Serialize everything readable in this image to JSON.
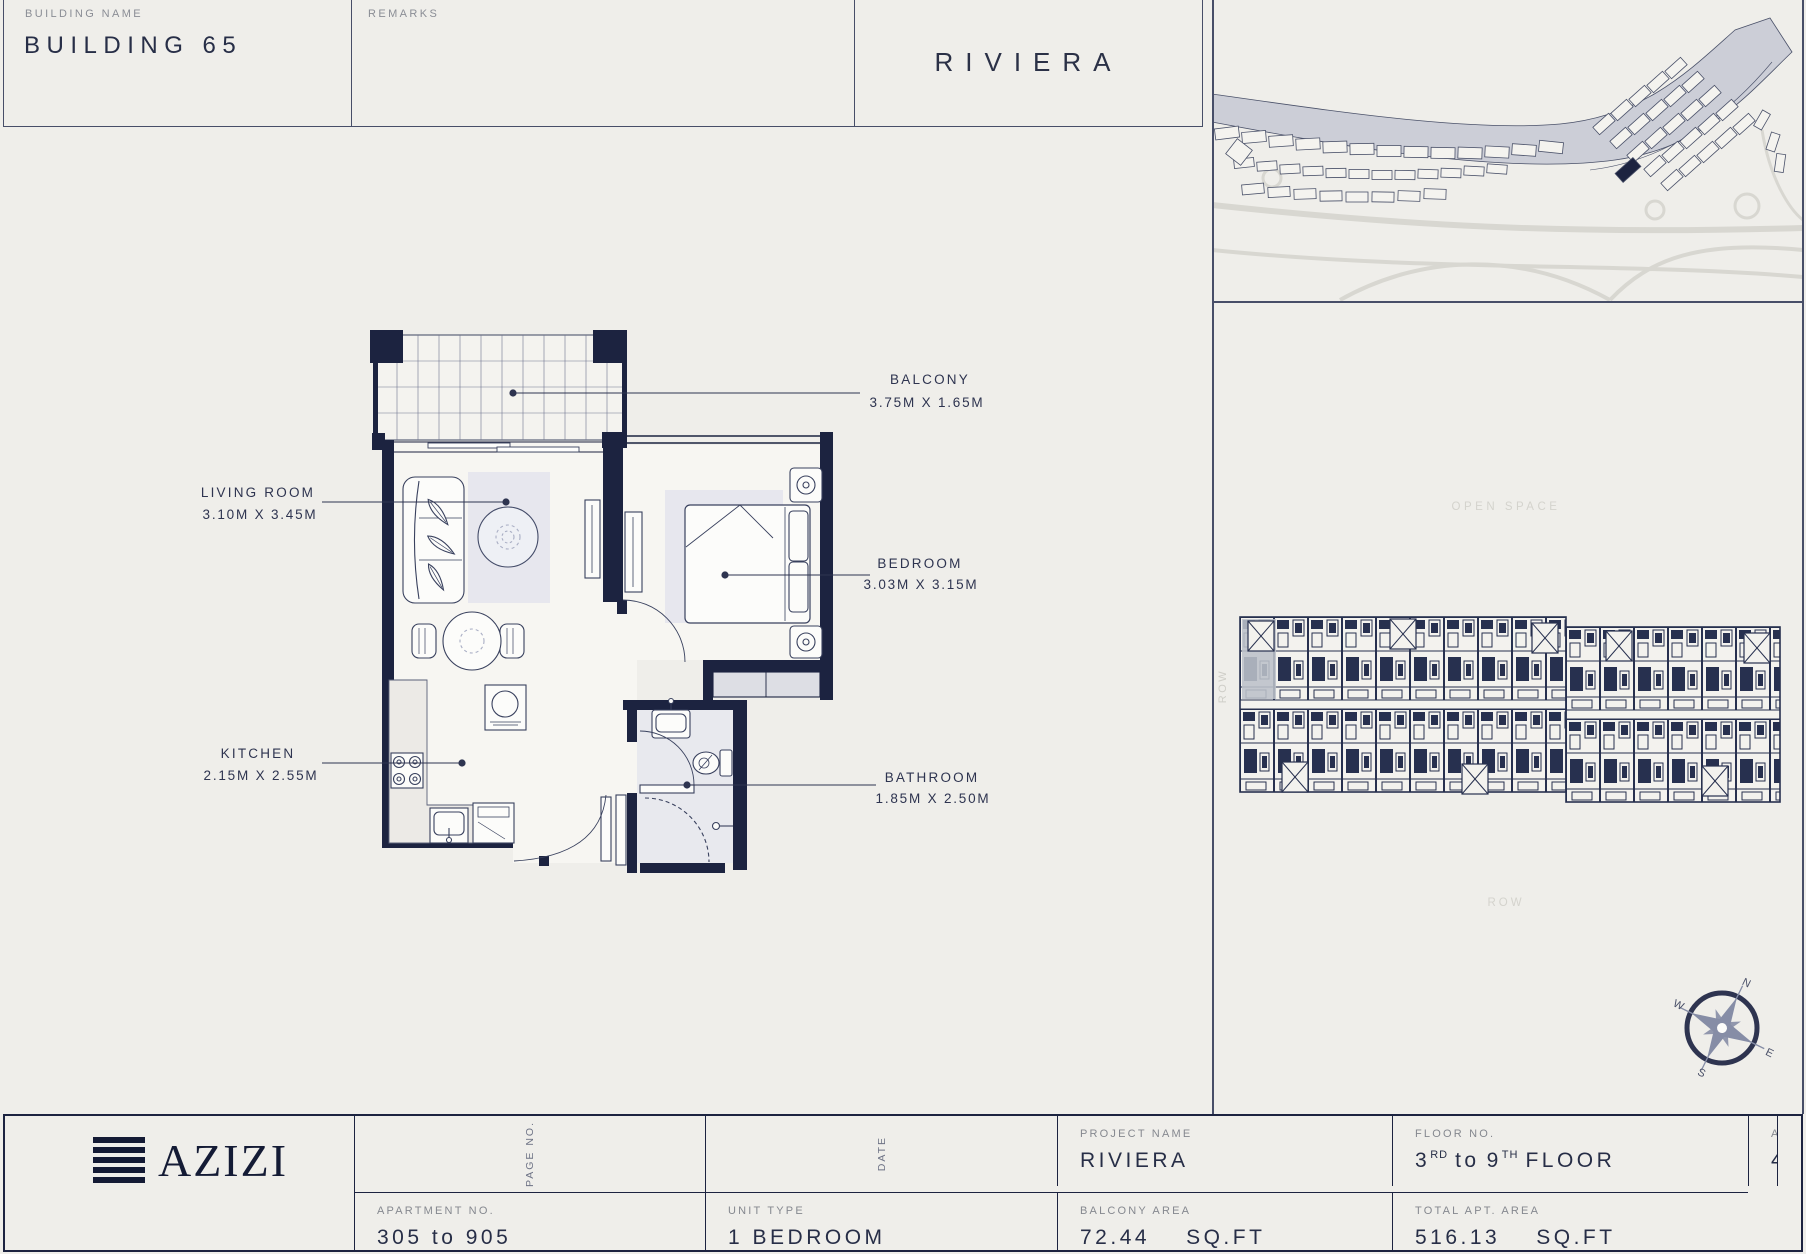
{
  "header": {
    "building_name_label": "BUILDING NAME",
    "building_name": "BUILDING 65",
    "remarks_label": "REMARKS",
    "title": "RIVIERA"
  },
  "plan": {
    "balcony": {
      "name": "BALCONY",
      "dims": "3.75M X 1.65M"
    },
    "living": {
      "name": "LIVING ROOM",
      "dims": "3.10M X 3.45M"
    },
    "bedroom": {
      "name": "BEDROOM",
      "dims": "3.03M X 3.15M"
    },
    "kitchen": {
      "name": "KITCHEN",
      "dims": "2.15M X 2.55M"
    },
    "bathroom": {
      "name": "BATHROOM",
      "dims": "1.85M X 2.50M"
    }
  },
  "site": {
    "open_space_label": "OPEN SPACE",
    "row_label": "ROW",
    "row_side_label": "ROW",
    "compass": {
      "n": "N",
      "e": "E",
      "s": "S",
      "w": "W"
    }
  },
  "footer": {
    "logo_text": "AZIZI",
    "project": {
      "label": "PROJECT NAME",
      "value": "RIVIERA"
    },
    "floor": {
      "label": "FLOOR NO.",
      "num1": "3",
      "sup1": "RD",
      "mid": "to",
      "num2": "9",
      "sup2": "TH",
      "tail": "FLOOR"
    },
    "apt_area": {
      "label": "APT. AREA",
      "value": "443.69",
      "unit": "SQ.FT"
    },
    "apartment_no": {
      "label": "APARTMENT NO.",
      "value": "305 to 905"
    },
    "unit_type": {
      "label": "UNIT TYPE",
      "value": "1 BEDROOM"
    },
    "balcony_area": {
      "label": "BALCONY AREA",
      "value": "72.44",
      "unit": "SQ.FT"
    },
    "total_area": {
      "label": "TOTAL APT. AREA",
      "value": "516.13",
      "unit": "SQ.FT"
    },
    "page_no_label": "PAGE NO.",
    "date_label": "DATE"
  },
  "colors": {
    "navy": "#1c2340",
    "paper": "#efeeea",
    "highlight": "#bcc0ca"
  }
}
